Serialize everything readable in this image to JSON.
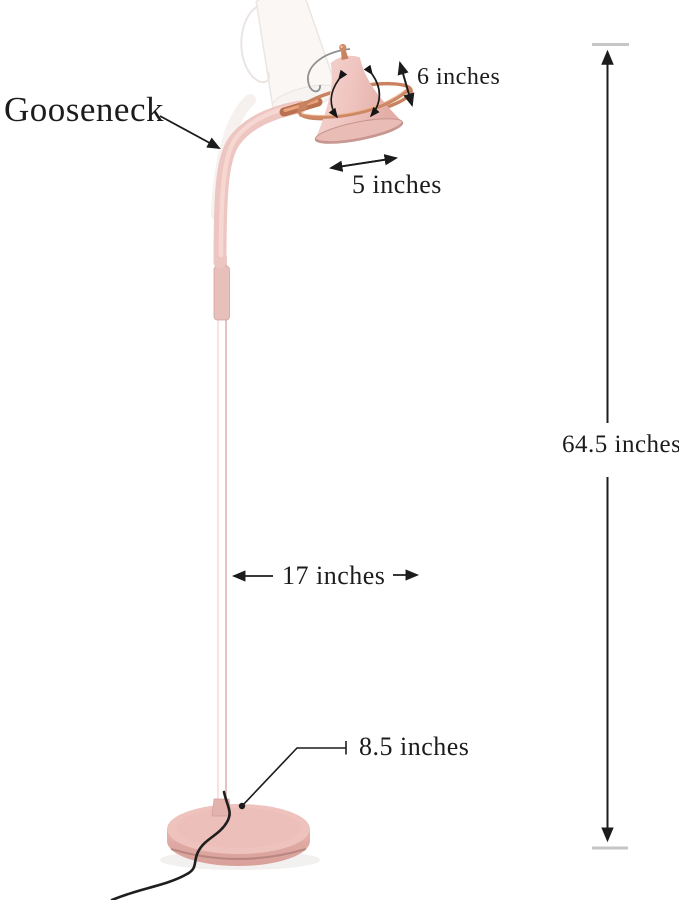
{
  "page": {
    "background": "#ffffff",
    "width": 679,
    "height": 900,
    "type": "product-dimension-diagram"
  },
  "product": {
    "name": "gooseneck floor lamp",
    "colors": {
      "lamp_pink": "#eec6c1",
      "shade_pink_light": "#f6d4d0",
      "shade_pink_dark": "#e6b2ac",
      "copper": "#c9825f",
      "copper_highlight": "#f0b795",
      "cord_black": "#1e1e1e",
      "annotation_black": "#1c1c1c",
      "cap_gray": "#c6c6c6",
      "ghost_white": "#f6f2ef"
    }
  },
  "annotations": {
    "gooseneck": {
      "label": "Gooseneck"
    },
    "shade_depth": {
      "label": "6 inches"
    },
    "shade_width": {
      "label": "5 inches"
    },
    "total_height": {
      "label": "64.5 inches"
    },
    "reach": {
      "label": "17 inches"
    },
    "base_diameter": {
      "label": "8.5 inches"
    }
  }
}
